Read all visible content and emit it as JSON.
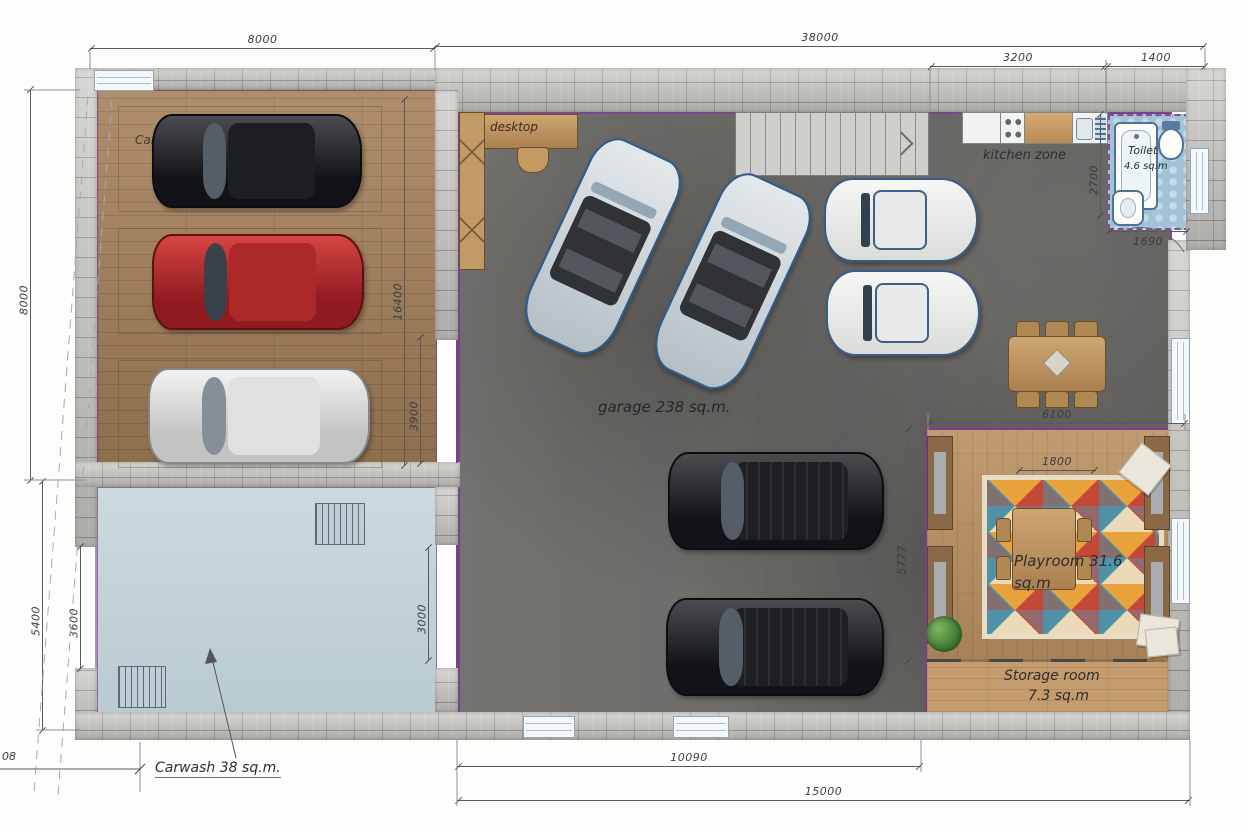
{
  "title": "Garage floor plan",
  "palette": {
    "stone_wall": "#c7c6c2",
    "wing_wood_floor": "#a5815a",
    "garage_concrete": "#6e6c69",
    "carwash_floor": "#c2d1d8",
    "toilet_tile": "#a2c2d5",
    "playroom_floor": "#b98f60",
    "partition_purple": "#7d3f8d",
    "dimension_line": "#5a5a5a",
    "car_black": "#121317",
    "car_red": "#a72025",
    "car_silver": "#dcdedc",
    "car_white_classic": "#f4f5f3",
    "car_convertible_outline": "#2e5c8c",
    "rug_colors": [
      "#cf4a36",
      "#ecd9b8",
      "#4a9aa8",
      "#e9a23b"
    ]
  },
  "labels": {
    "wing": "Carshine Land",
    "desk": "desktop",
    "kitchen": "kitchen zone",
    "toilet_line1": "Toilet",
    "toilet_line2": "4.6 sq.m",
    "garage": "garage 238 sq.m.",
    "playroom_line1": "Playroom 31.6",
    "playroom_line2": "sq.m",
    "storage_line1": "Storage room",
    "storage_line2": "7.3 sq.m",
    "carwash": "Carwash 38 sq.m."
  },
  "dimensions": {
    "wing_top": "8000",
    "main_top": "38000",
    "kitchen_top": "3200",
    "toilet_top": "1400",
    "left_upper": "8000",
    "left_lower": "5400",
    "carwash_door": "3600",
    "carwash_side": "3000",
    "wing_inner_long": "16400",
    "wing_inner_door": "3900",
    "toilet_side": "2700",
    "toilet_width": "1690",
    "playroom_top": "6100",
    "playroom_inner": "1800",
    "playroom_side": "5777",
    "garage_bottom": "10090",
    "building_bottom": "15000",
    "edge_partial": "08"
  }
}
